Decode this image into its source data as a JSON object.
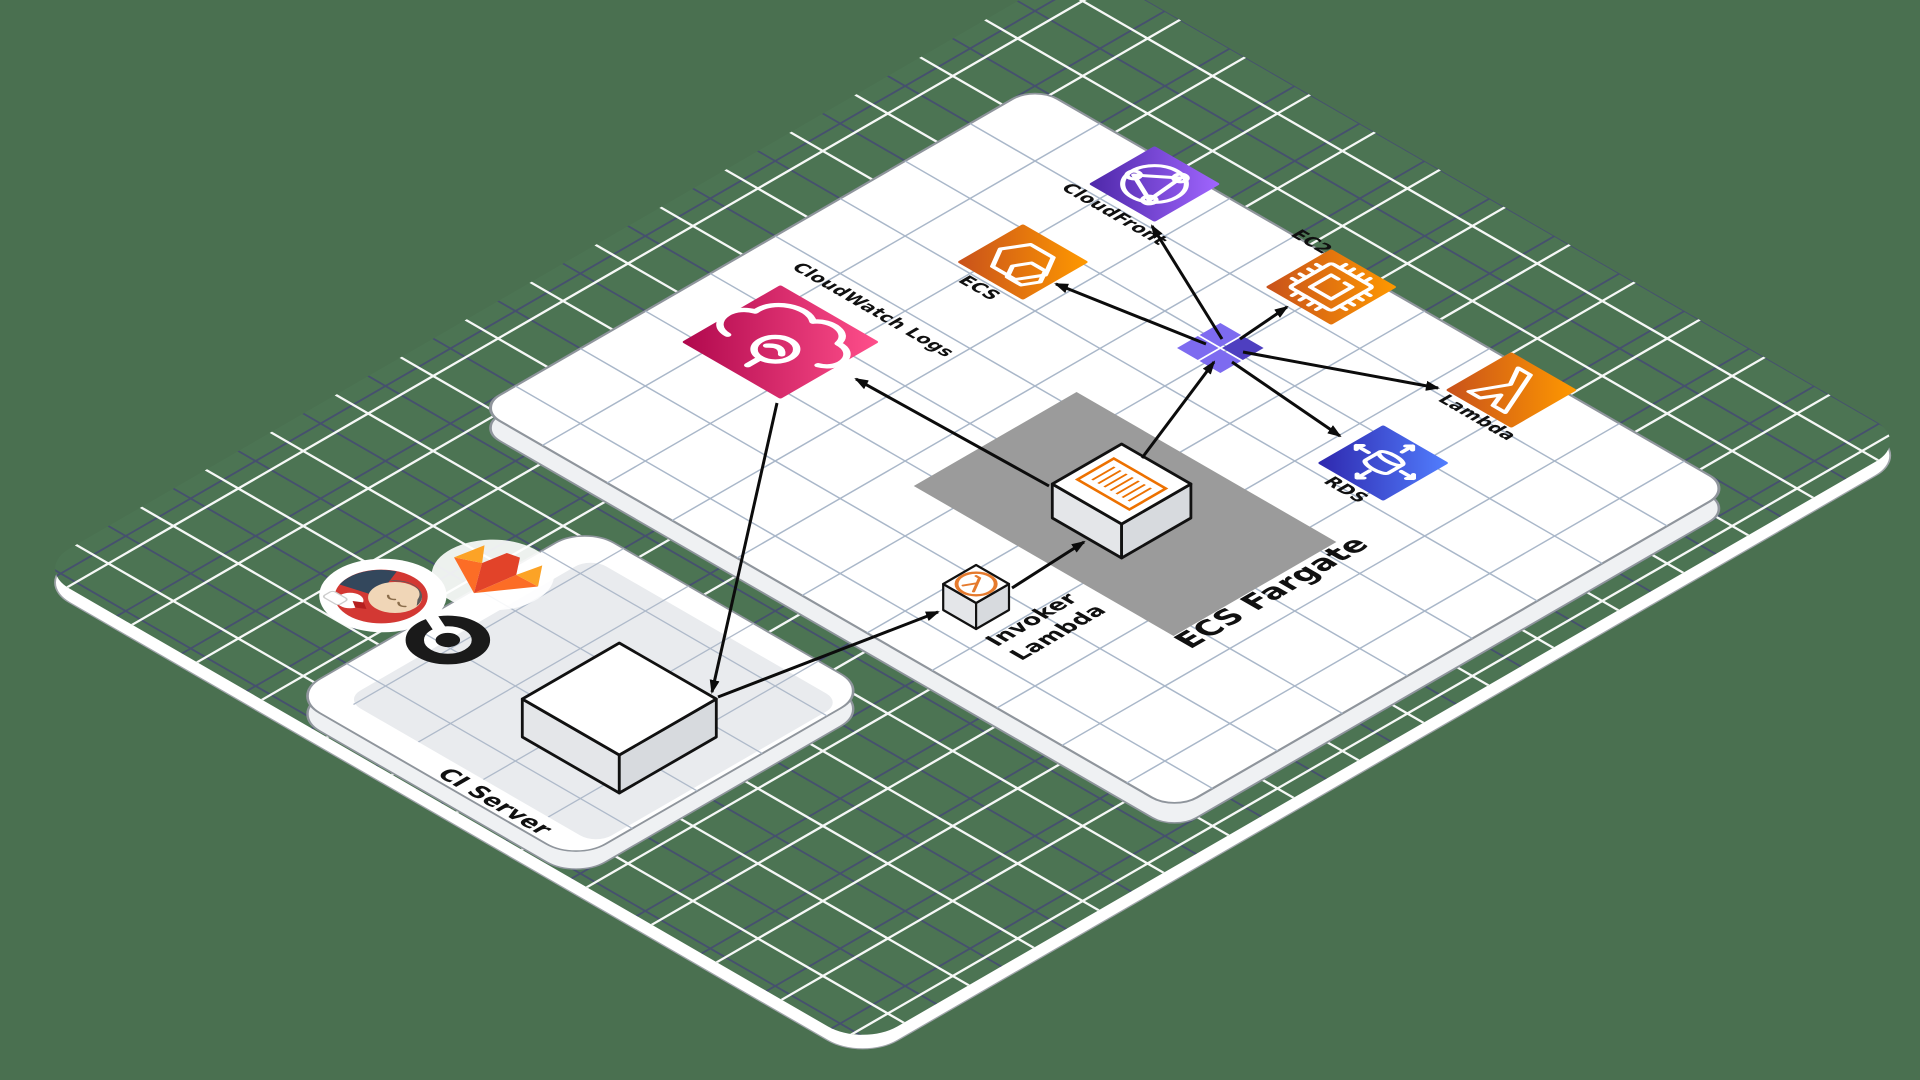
{
  "diagram": {
    "colors": {
      "background": "#4A7050",
      "floor_green": "#4C7453",
      "floor_grid_navy": "#46506F",
      "floor_grid_white": "#FFFFFF",
      "plane_white": "#FFFFFF",
      "plane_grid": "#A9B7C9",
      "plane_border": "#8F959C",
      "plane_side": "#EFF1F3",
      "ci_inner": "#E9EBEE",
      "zone_gray": "#9B9B9B",
      "arrow_black": "#0C0C0C",
      "box_stroke": "#111111",
      "box_side_sw": "#E4E6E9",
      "box_side_se": "#D7DADE",
      "fargate_icon_orange": "#ED7100",
      "invoker_icon_orange": "#E57A2D",
      "junction_light": "#7D6BF0",
      "junction_dark": "#4E3FC0"
    },
    "projection": {
      "ox": 1035,
      "oy": 86,
      "c": 0.866,
      "s": 0.5,
      "tile": 75
    },
    "floor": {
      "u0": -95,
      "v0": -150,
      "u1": 861,
      "v1": 1060,
      "rx": 40,
      "rim_dy": 14
    },
    "services_plane": {
      "u0": 0,
      "v0": 0,
      "u1": 805,
      "v1": 644,
      "rx": 26,
      "side_dy": 20
    },
    "ci_platform": {
      "label": "CI Server",
      "label_anchor": [
        343,
        1035
      ],
      "label_size": 23,
      "u0": 180,
      "v0": 700,
      "u1": 510,
      "v1": 1040,
      "rx": 34,
      "side_dy": 18,
      "inner": {
        "u0": 215,
        "v0": 728,
        "u1": 505,
        "v1": 1012,
        "rx": 18
      }
    },
    "fargate_zone": {
      "label": "ECS Fargate",
      "label_anchor": [
        653,
        474
      ],
      "label_size": 30,
      "u0": 330,
      "v0": 282,
      "u1": 630,
      "v1": 470
    },
    "nodes": [
      {
        "id": "cloudwatch-logs",
        "label": "CloudWatch Logs",
        "u": 109,
        "v": 403,
        "hs": 57,
        "glyph": "cloudwatch",
        "grad": [
          "#B0084D",
          "#FF4F8B"
        ],
        "label_anchor": [
          41,
          323
        ],
        "label_size": 18
      },
      {
        "id": "ecs",
        "label": "ECS",
        "u": 169,
        "v": 183,
        "hs": 38,
        "glyph": "ecs",
        "grad": [
          "#C8511B",
          "#FF9900"
        ],
        "label_anchor": [
          150,
          240
        ],
        "label_size": 18
      },
      {
        "id": "cloudfront",
        "label": "CloudFront",
        "u": 167,
        "v": 29,
        "hs": 38,
        "glyph": "cloudfront",
        "grad": [
          "#4D27A8",
          "#A166FF"
        ],
        "label_anchor": [
          117,
          88
        ],
        "label_size": 18
      },
      {
        "id": "ec2",
        "label": "EC2",
        "u": 372,
        "v": 30,
        "hs": 38,
        "glyph": "ec2",
        "grad": [
          "#C8511B",
          "#FF9900"
        ],
        "label_anchor": [
          296,
          2
        ],
        "label_size": 18
      },
      {
        "id": "lambda",
        "label": "Lambda",
        "u": 579,
        "v": 29,
        "hs": 38,
        "glyph": "lambda",
        "grad": [
          "#C8511B",
          "#FF9900"
        ],
        "label_anchor": [
          546,
          82
        ],
        "label_size": 18
      },
      {
        "id": "rds",
        "label": "RDS",
        "u": 578,
        "v": 176,
        "hs": 38,
        "glyph": "rds",
        "grad": [
          "#2E27AD",
          "#527FFF"
        ],
        "label_anchor": [
          562,
          230
        ],
        "label_size": 18
      }
    ],
    "boxes": [
      {
        "id": "fargate-task",
        "u0": 442,
        "v0": 342,
        "u1": 522,
        "v1": 422,
        "h": 34,
        "top": "log-lines"
      },
      {
        "id": "invoker-lambda",
        "label_lines": [
          "Invoker",
          "Lambda"
        ],
        "label_anchor": [
          539,
          583
        ],
        "label_size": 22,
        "line_step": 28,
        "u0": 471,
        "v0": 539,
        "u1": 509,
        "v1": 577,
        "h": 26,
        "top": "lambda-circle"
      },
      {
        "id": "ci-server-box",
        "u0": 355,
        "v0": 835,
        "u1": 467,
        "v1": 947,
        "h": 38,
        "top": "none"
      }
    ],
    "logos": [
      {
        "id": "jenkins",
        "u": 133,
        "v": 886
      },
      {
        "id": "gitlab",
        "u": 176,
        "v": 802
      },
      {
        "id": "circleci",
        "u": 215,
        "v": 893
      }
    ],
    "junction": {
      "u": 369,
      "v": 155,
      "size": 24,
      "offset": 13
    },
    "arrows": [
      {
        "name": "fargate-to-cloudwatch",
        "from": [
          1049,
          486
        ],
        "to": [
          856,
          379
        ]
      },
      {
        "name": "cloudwatch-to-ci",
        "from": [
          777,
          403
        ],
        "to": [
          712,
          692
        ]
      },
      {
        "name": "ci-to-invoker",
        "from": [
          718,
          697
        ],
        "to": [
          938,
          612
        ]
      },
      {
        "name": "invoker-to-fargate",
        "from": [
          1012,
          588
        ],
        "to": [
          1084,
          542
        ]
      },
      {
        "name": "fargate-to-junction",
        "from": [
          1142,
          458
        ],
        "to": [
          1214,
          362
        ]
      },
      {
        "name": "junction-to-ecs",
        "from": [
          1206,
          344
        ],
        "to": [
          1056,
          284
        ]
      },
      {
        "name": "junction-to-cloudfront",
        "from": [
          1222,
          339
        ],
        "to": [
          1152,
          226
        ]
      },
      {
        "name": "junction-to-ec2",
        "from": [
          1240,
          339
        ],
        "to": [
          1287,
          307
        ]
      },
      {
        "name": "junction-to-lambda",
        "from": [
          1243,
          352
        ],
        "to": [
          1438,
          388
        ]
      },
      {
        "name": "junction-to-rds",
        "from": [
          1232,
          362
        ],
        "to": [
          1340,
          436
        ]
      }
    ]
  }
}
